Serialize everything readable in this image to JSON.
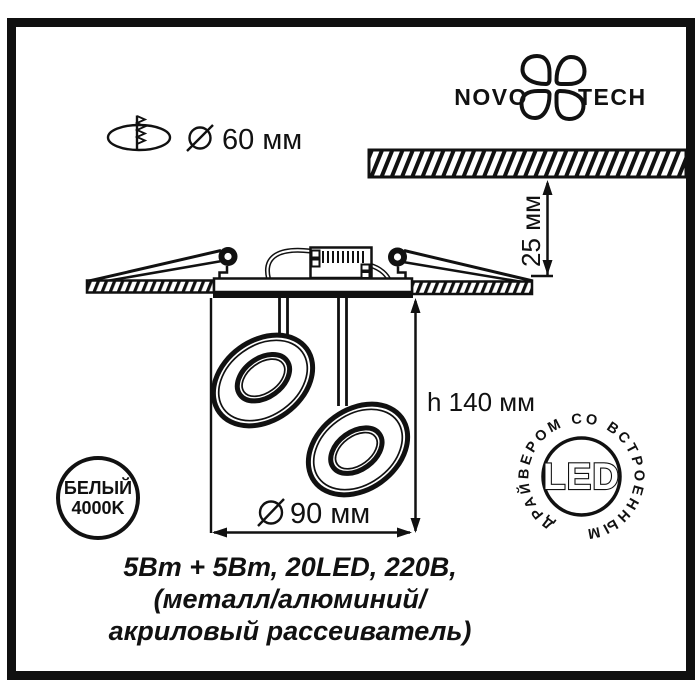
{
  "colors": {
    "ink": "#111111",
    "paper": "#ffffff"
  },
  "header": {
    "cutout_diameter_label": "60 мм",
    "logo": {
      "left": "NOVO",
      "right": "TECH"
    }
  },
  "dimensions": {
    "recess_depth": "25 мм",
    "fixture_height": "h 140 мм",
    "fixture_diameter": "90 мм"
  },
  "badges": {
    "color_temperature": {
      "line1": "БЕЛЫЙ",
      "line2": "4000K"
    },
    "led_stamp": {
      "center_label": "LED",
      "ring_label": "ДРАЙВЕРОМ СО ВСТРОЕННЫМ"
    }
  },
  "caption": {
    "line1": "5Вт + 5Вт, 20LED, 220В,",
    "line2": "(металл/алюминий/",
    "line3": "акриловый рассеиватель)"
  }
}
